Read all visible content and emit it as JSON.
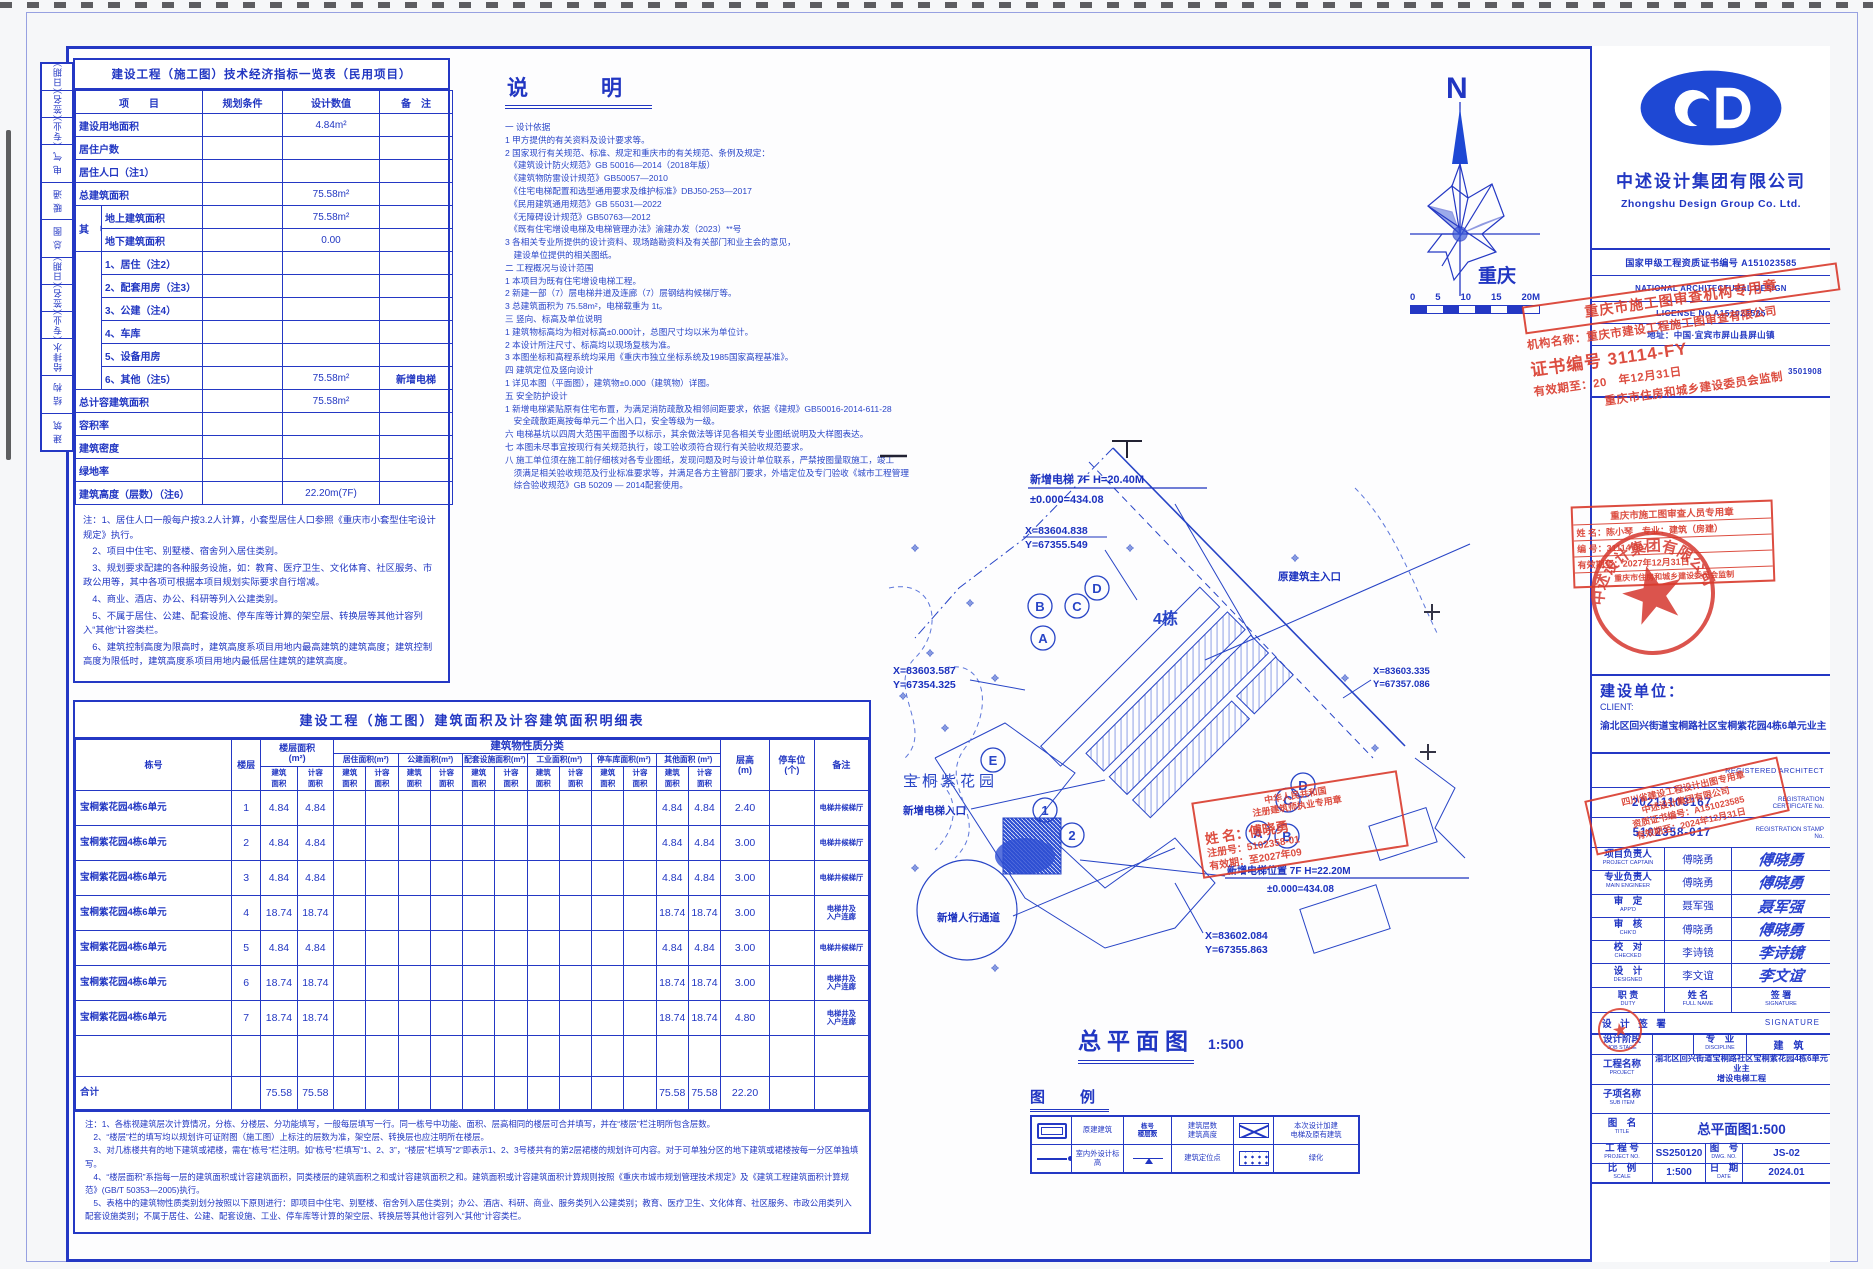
{
  "sheet": {
    "plan_title": "总平面图",
    "plan_scale": "1:500"
  },
  "signoff_strip": {
    "cells": [
      "（日期）",
      "（签名）",
      "（专业）",
      "电 气",
      "暖 通",
      "总 图",
      "（日期）",
      "（签名）",
      "（专业）",
      "给排水",
      "结 构",
      "建 筑"
    ]
  },
  "indicator_table": {
    "title": "建设工程（施工图）技术经济指标一览表（民用项目）",
    "headers": [
      "项　　目",
      "规划条件",
      "设计数值",
      "备　注"
    ],
    "rows": [
      {
        "t": "f",
        "label": "建设用地面积",
        "cond": "",
        "value": "4.84m²",
        "note": ""
      },
      {
        "t": "f",
        "label": "居住户数",
        "cond": "",
        "value": "",
        "note": ""
      },
      {
        "t": "f",
        "label": "居住人口（注1）",
        "cond": "",
        "value": "",
        "note": ""
      },
      {
        "t": "f",
        "label": "总建筑面积",
        "cond": "",
        "value": "75.58m²",
        "note": ""
      },
      {
        "t": "g1",
        "group": "其 中",
        "label": "地上建筑面积",
        "cond": "",
        "value": "75.58m²",
        "note": ""
      },
      {
        "t": "g2",
        "label": "地下建筑面积",
        "cond": "",
        "value": "0.00",
        "note": ""
      },
      {
        "t": "s1",
        "label": "1、居住（注2）",
        "cond": "",
        "value": "",
        "note": ""
      },
      {
        "t": "s",
        "label": "2、配套用房（注3）",
        "cond": "",
        "value": "",
        "note": ""
      },
      {
        "t": "s",
        "label": "3、公建（注4）",
        "cond": "",
        "value": "",
        "note": ""
      },
      {
        "t": "s",
        "label": "4、车库",
        "cond": "",
        "value": "",
        "note": ""
      },
      {
        "t": "s",
        "label": "5、设备用房",
        "cond": "",
        "value": "",
        "note": ""
      },
      {
        "t": "s",
        "label": "6、其他（注5）",
        "cond": "",
        "value": "75.58m²",
        "note": "新增电梯"
      },
      {
        "t": "f",
        "label": "总计容建筑面积",
        "cond": "",
        "value": "75.58m²",
        "note": ""
      },
      {
        "t": "f",
        "label": "容积率",
        "cond": "",
        "value": "",
        "note": ""
      },
      {
        "t": "f",
        "label": "建筑密度",
        "cond": "",
        "value": "",
        "note": ""
      },
      {
        "t": "f",
        "label": "绿地率",
        "cond": "",
        "value": "",
        "note": ""
      },
      {
        "t": "f",
        "label": "建筑高度（层数）（注6）",
        "cond": "",
        "value": "22.20m(7F)",
        "note": ""
      }
    ],
    "notes": [
      "注：1、居住人口一般每户按3.2人计算，小套型居住人口参照《重庆市小套型住宅设计规定》执行。",
      "　2、项目中住宅、别墅楼、宿舍列入居住类别。",
      "　3、规划要求配建的各种服务设施，如：教育、医疗卫生、文化体育、社区服务、市政公用等，其中各项可根据本项目规划实际要求自行增减。",
      "　4、商业、酒店、办公、科研等列入公建类别。",
      "　5、不属于居住、公建、配套设施、停车库等计算的架空层、转换层等其他计容列入“其他”计容类栏。",
      "　6、建筑控制高度为限高时，建筑高度系项目用地内最高建筑的建筑高度；建筑控制高度为限低时，建筑高度系项目用地内最低居住建筑的建筑高度。"
    ]
  },
  "shuoming": {
    "title": "说　明",
    "lines": [
      "一 设计依据",
      "1 甲方提供的有关资料及设计要求等。",
      "2 国家现行有关规范、标准、规定和重庆市的有关规范、条例及规定：",
      "　《建筑设计防火规范》GB 50016—2014（2018年版）",
      "　《建筑物防雷设计规范》GB50057—2010",
      "　《住宅电梯配置和选型通用要求及维护标准》DBJ50-253—2017",
      "　《民用建筑通用规范》GB 55031—2022",
      "　《无障碍设计规范》GB50763—2012",
      "　《既有住宅增设电梯及电梯管理办法》渝建办发（2023）**号",
      "3 各相关专业所提供的设计资料、现场踏勘资料及有关部门和业主会的意见，",
      "　建设单位提供的相关图纸。",
      "二 工程概况与设计范围",
      "1 本项目为既有住宅增设电梯工程。",
      "2 新建一部（7）层电梯井道及连廊（7）层钢结构候梯厅等。",
      "3 总建筑面积为 75.58m²，电梯载重为 1t。",
      "三 竖向、标高及单位说明",
      "1 建筑物标高均为相对标高±0.000计，总图尺寸均以米为单位计。",
      "2 本设计所注尺寸、标高均以现场复核为准。",
      "3 本图坐标和高程系统均采用《重庆市独立坐标系统及1985国家高程基准》。",
      "四 建筑定位及竖向设计",
      "1 详见本图（平面图），建筑物±0.000（建筑物）详图。",
      "五 安全防护设计",
      "1 新增电梯紧贴原有住宅布置，为满足消防疏散及相邻间距要求，依据《建规》GB50016-2014-611-28",
      "　安全疏散距离按每单元二个出入口，安全等级为一级。",
      "六 电梯基坑以四周大范围平面图予以标示，其余做法等详见各相关专业图纸说明及大样图表达。",
      "七 本图未尽事宜按现行有关规范执行，竣工验收须符合现行有关验收规范要求。",
      "八 施工单位须在施工前仔细核对各专业图纸，发现问题及时与设计单位联系，严禁按图量取施工，竣工",
      "　须满足相关验收规范及行业标准要求等，并满足各方主管部门要求，外墙定位及专门验收《城市工程管理",
      "　综合验收规范》GB 50209 — 2014配套使用。"
    ]
  },
  "compass": {
    "north_label": "N",
    "city_label": "重庆",
    "scale_labels": [
      "0",
      "5",
      "10",
      "15",
      "20M"
    ]
  },
  "company": {
    "name_cn": "中述设计集团有限公司",
    "name_en": "Zhongshu Design Group Co.  Ltd.",
    "rows": [
      "国家甲级工程资质证书编号 A151023585",
      "NATIONAL  ARCHITECTURAL  DESIGN",
      "LICENSE  No  A151023585",
      "地址：中国·宜宾市屏山县屏山镇"
    ],
    "serial": "3501908"
  },
  "stamps": {
    "review_org": {
      "title": "重庆市施工图审查机构专用章",
      "org": "机构名称：重庆市建设工程施工图审查有限公司",
      "no": "证书编号 31114-FY",
      "valid": "有效期至：20　年12月31日",
      "footer": "重庆市住房和城乡建设委员会监制"
    },
    "reviewer": {
      "title": "重庆市施工图审查人员专用章",
      "name": "姓 名：陈小琴　专业：建筑（房建）",
      "no": "编 号：31114 007",
      "valid": "有效期至：2027年12月31日",
      "footer": "重庆市住房和城乡建设委员会监制"
    },
    "company_seal": "中述设计集团有限公司",
    "chutu": {
      "l1": "四川省建设工程设计出图专用章",
      "l2": "中述设计集团有限公司",
      "l3": "资质证书编号：A151023585",
      "l4": "有效期至：2024年12月31日"
    },
    "architect": {
      "l1": "中华人民共和国",
      "l2": "注册建筑师执业专用章",
      "name": "姓 名：傅晓勇",
      "no": "注册号：5102358-01",
      "valid": "有效期：至2027年09"
    }
  },
  "client": {
    "label_cn": "建设单位：",
    "label_en": "CLIENT:",
    "value": "渝北区回兴街道宝桐路社区宝桐紫花园4栋6单元业主"
  },
  "registered_architect": "REGISTERED  ARCHITECT",
  "cert_rows": [
    {
      "value": "20211103167",
      "en": "REGISTRATION CERTIFICATE No."
    },
    {
      "value": "5102358-017",
      "en": "REGISTRATION STAMP No."
    }
  ],
  "signature_table": {
    "rows": [
      {
        "role": "项目负责人",
        "en": "PROJECT CAPTAIN",
        "name": "傅晓勇",
        "sig": "傅晓勇"
      },
      {
        "role": "专业负责人",
        "en": "MAIN ENGINEER",
        "name": "傅晓勇",
        "sig": "傅晓勇"
      },
      {
        "role": "审　定",
        "en": "APP'D",
        "name": "聂军强",
        "sig": "聂军强"
      },
      {
        "role": "审　核",
        "en": "CHK'D",
        "name": "傅晓勇",
        "sig": "傅晓勇"
      },
      {
        "role": "校　对",
        "en": "CHECKED",
        "name": "李诗镜",
        "sig": "李诗镜"
      },
      {
        "role": "设　计",
        "en": "DESIGNED",
        "name": "李文谊",
        "sig": "李文谊"
      }
    ],
    "footer": {
      "duty_cn": "职 责",
      "duty_en": "DUTY",
      "name_cn": "姓 名",
      "name_en": "FULL NAME",
      "sig_cn": "签 署",
      "sig_en": "SIGNATURE"
    },
    "section": {
      "cn": "设 计 签 署",
      "en": "SIGNATURE"
    }
  },
  "title_block": {
    "stage_label": "设计阶段",
    "stage_en": "JOB STAGE",
    "stage_value": "",
    "discipline_label": "专　业",
    "discipline_en": "DISCIPLINE",
    "discipline_value": "建　筑",
    "project_label": "工程名称",
    "project_en": "PROJECT",
    "project_value1": "渝北区回兴街道宝桐路社区宝桐紫花园4栋6单元业主",
    "project_value2": "增设电梯工程",
    "subitem_label": "子项名称",
    "subitem_en": "SUB ITEM",
    "subitem_value": "",
    "title_label": "图　名",
    "title_en": "TITLE",
    "title_value": "总平面图1:500",
    "projno_label": "工 程 号",
    "projno_en": "PROJECT NO.",
    "projno_value": "SS250120",
    "dwgno_label": "图　号",
    "dwgno_en": "DWG. NO.",
    "dwgno_value": "JS-02",
    "scale_label": "比　例",
    "scale_en": "SCALE",
    "scale_value": "1:500",
    "date_label": "日　期",
    "date_en": "DATE",
    "date_value": "2024.01"
  },
  "area_table": {
    "title": "建设工程（施工图）建筑面积及计容建筑面积明细表",
    "h_dong": "栋号",
    "h_floor": "楼层",
    "h_floor_area": "楼层面积\n(m²)",
    "h_class": "建筑物性质分类",
    "class_cols": [
      "居住面积(m²)",
      "公建面积(m²)",
      "配套设施面积(m²)",
      "工业面积(m²)",
      "停车库面积(m²)",
      "其他面积 (m²)"
    ],
    "pair": [
      "建筑\n面积",
      "计容\n面积"
    ],
    "h_height": "层高\n(m)",
    "h_parking": "停车位\n(个)",
    "h_note": "备注",
    "rows": [
      {
        "name": "宝桐紫花园4栋6单元",
        "floor": "1",
        "a1": "4.84",
        "a2": "4.84",
        "o1": "4.84",
        "o2": "4.84",
        "h": "2.40",
        "note": "电梯井候梯厅"
      },
      {
        "name": "宝桐紫花园4栋6单元",
        "floor": "2",
        "a1": "4.84",
        "a2": "4.84",
        "o1": "4.84",
        "o2": "4.84",
        "h": "3.00",
        "note": "电梯井候梯厅"
      },
      {
        "name": "宝桐紫花园4栋6单元",
        "floor": "3",
        "a1": "4.84",
        "a2": "4.84",
        "o1": "4.84",
        "o2": "4.84",
        "h": "3.00",
        "note": "电梯井候梯厅"
      },
      {
        "name": "宝桐紫花园4栋6单元",
        "floor": "4",
        "a1": "18.74",
        "a2": "18.74",
        "o1": "18.74",
        "o2": "18.74",
        "h": "3.00",
        "note": "电梯井及\n入户连廊"
      },
      {
        "name": "宝桐紫花园4栋6单元",
        "floor": "5",
        "a1": "4.84",
        "a2": "4.84",
        "o1": "4.84",
        "o2": "4.84",
        "h": "3.00",
        "note": "电梯井候梯厅"
      },
      {
        "name": "宝桐紫花园4栋6单元",
        "floor": "6",
        "a1": "18.74",
        "a2": "18.74",
        "o1": "18.74",
        "o2": "18.74",
        "h": "3.00",
        "note": "电梯井及\n入户连廊"
      },
      {
        "name": "宝桐紫花园4栋6单元",
        "floor": "7",
        "a1": "18.74",
        "a2": "18.74",
        "o1": "18.74",
        "o2": "18.74",
        "h": "4.80",
        "note": "电梯井及\n入户连廊"
      }
    ],
    "total_label": "合计",
    "total": {
      "a1": "75.58",
      "a2": "75.58",
      "o1": "75.58",
      "o2": "75.58",
      "h": "22.20"
    },
    "notes": [
      "注：1、各栋视建筑层次计算情况，分栋、分楼层、分功能填写，一般每层填写一行。同一栋号中功能、面积、层高相同的楼层可合并填写，并在“楼层”栏注明所包含层数。",
      "　2、“楼层”栏的填写均以规划许可证附图（施工图）上标注的层数为准，架空层、转换层也应注明所在楼层。",
      "　3、对几栋楼共有的地下建筑或裙楼，需在“栋号”栏注明。如“栋号”栏填写“1、2、3”，“楼层”栏填写“2”即表示1、2、3号楼共有的第2层裙楼的规划许可内容。对于可单独分区的地下建筑或裙楼按每一分区单独填写。",
      "　4、“楼层面积”系指每一层的建筑面积或计容建筑面积，同类楼层的建筑面积之和或计容建筑面积之和。建筑面积或计容建筑面积计算规则按照《重庆市城市规划管理技术规定》及《建筑工程建筑面积计算规范》(GB/T 50353—2005)执行。",
      "　5、表格中的建筑物性质类别划分按照以下原则进行：即项目中住宅、别墅楼、宿舍列入居住类别；办公、酒店、科研、商业、服务类列入公建类别；教育、医疗卫生、文化体育、社区服务、市政公用类列入配套设施类别；不属于居住、公建、配套设施、工业、停车库等计算的架空层、转换层等其他计容列入“其他”计容类栏。"
    ]
  },
  "site_plan": {
    "area_name": "宝桐紫花园",
    "bld_label": "4栋",
    "new_elev_top1": "新增电梯 7F H=20.40M",
    "new_elev_top2": "±0.000=434.08",
    "new_elev_pos1": "新增电梯位置 7F H=22.20M",
    "new_elev_pos2": "±0.000=434.08",
    "entry_main": "原建筑主入口",
    "entry_elev": "新增电梯入口",
    "walkway": "新增人行通道",
    "coords": [
      {
        "x": "X=83604.838",
        "y": "Y=67355.549"
      },
      {
        "x": "X=83603.587",
        "y": "Y=67354.325"
      },
      {
        "x": "X=83603.335",
        "y": "Y=67357.086"
      },
      {
        "x": "X=83602.084",
        "y": "Y=67355.863"
      }
    ],
    "circles": [
      "D",
      "B",
      "C",
      "A",
      "E",
      "1",
      "2",
      "D",
      "C",
      "A",
      "B"
    ]
  },
  "legend": {
    "title": "图　例",
    "rows": [
      [
        {
          "sym": "rect",
          "label": ""
        },
        {
          "sym": "",
          "label": "原建建筑"
        },
        {
          "sym": "frac",
          "label": "栋号\n楼层数"
        },
        {
          "sym": "",
          "label": "建筑层数\n建筑高度"
        },
        {
          "sym": "xbox",
          "label": ""
        },
        {
          "sym": "",
          "label": "本次设计加建\n电梯及原有建筑"
        }
      ],
      [
        {
          "sym": "dotline",
          "label": ""
        },
        {
          "sym": "",
          "label": "室内外设计标高"
        },
        {
          "sym": "dim",
          "label": ""
        },
        {
          "sym": "",
          "label": "建筑定位点"
        },
        {
          "sym": "dotbox",
          "label": ""
        },
        {
          "sym": "",
          "label": "绿化"
        }
      ]
    ]
  }
}
